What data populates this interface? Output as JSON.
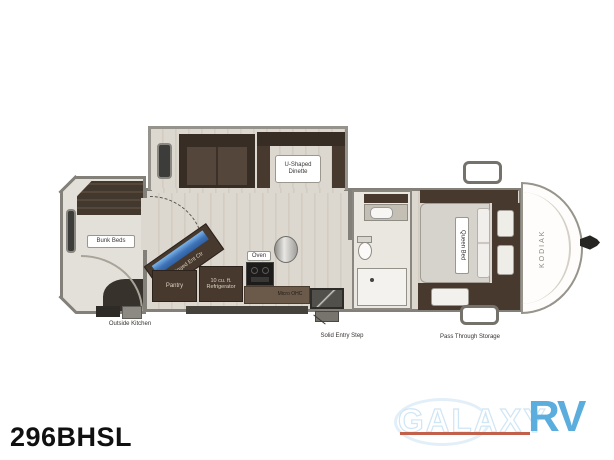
{
  "model_number": "296BHSL",
  "watermark": {
    "brand": "GALAXY",
    "suffix": "RV",
    "brand_color": "#5badde",
    "underline_color": "#c2604b"
  },
  "floorplan": {
    "make_vertical_text": "KODIAK",
    "labels": {
      "bunk_beds": "Bunk Beds",
      "outside_kitchen": "Outside Kitchen",
      "u_shaped_dinette": "U-Shaped Dinette",
      "hinged_ent_ctr": "Hinged Ent Ctr",
      "pantry": "Pantry",
      "refrigerator": "10 cu. ft. Refrigerator",
      "oven": "Oven",
      "micro_ohc": "Micro OHC",
      "solid_entry_step": "Solid Entry Step",
      "queen_bed": "Queen Bed",
      "pass_through_storage": "Pass Through Storage"
    },
    "colors": {
      "wall": "#83807a",
      "furniture_brown": "#47392e",
      "floor_wood": "#dcd7ce",
      "tv_screen_blue": "#3f74b8"
    }
  }
}
